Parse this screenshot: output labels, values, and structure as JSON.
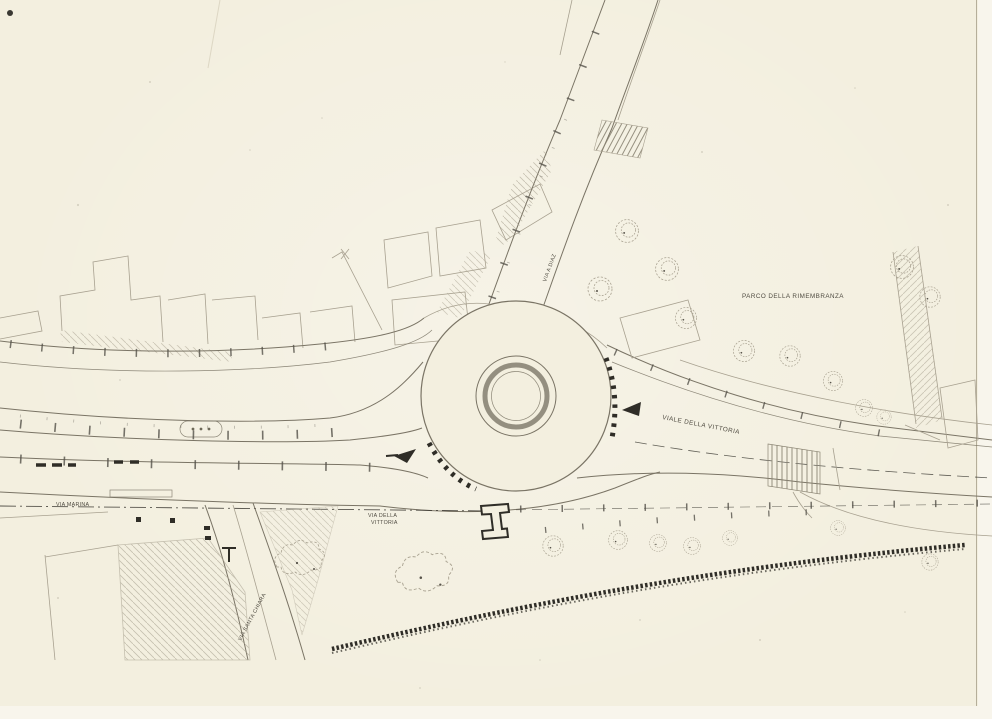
{
  "colors": {
    "paper": "#f3efdf",
    "paper-edge": "#f8f5ec",
    "ink": "#7a7465",
    "ink-dark": "#2f2d27",
    "ink-faint": "#a8a190",
    "label": "#4f4b41"
  },
  "labels": {
    "parco": {
      "text": "PARCO DELLA RIMEMBRANZA"
    },
    "viale_vittoria": {
      "text": "VIALE DELLA VITTORIA"
    },
    "via_diaz": {
      "text": "VIA A DIAZ"
    },
    "via_santa_chiara": {
      "text": "VIA SANTA CHIARA"
    },
    "via_marina": {
      "text": "VIA MARINA"
    },
    "via_della": {
      "text": "VIA DELLA"
    },
    "vittoria_line2": {
      "text": "VITTORIA"
    }
  },
  "symbols": {
    "roundabout": "roundabout-circle",
    "tree": "tree-symbol",
    "section_marker": "section-marker-I",
    "direction_arrow": "direction-arrow",
    "pedestrian_crossing": "zebra-crossing",
    "fence": "fence-line",
    "survey_ticks": "survey-tick-row"
  }
}
